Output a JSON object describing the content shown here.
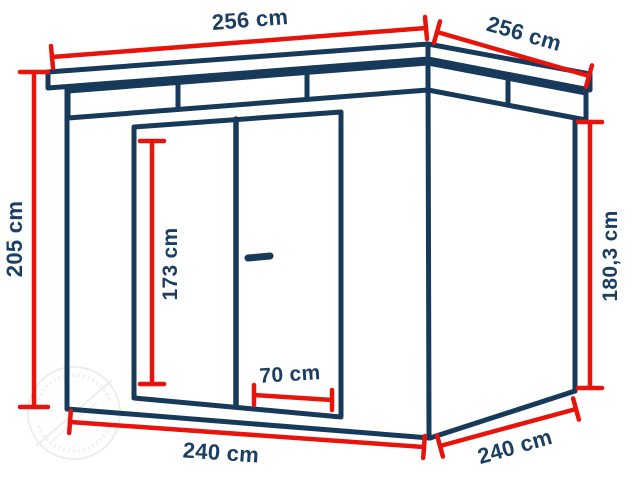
{
  "diagram": {
    "kind": "shed-dimension-drawing",
    "colors": {
      "outline_navy": "#17395a",
      "dimension_red": "#e8140c",
      "label_navy": "#1b3f63",
      "background": "#ffffff",
      "watermark_gray": "#d9d3cd"
    },
    "dimensions": {
      "roof_front_width": "256 cm",
      "roof_side_depth": "256 cm",
      "total_height_left": "205 cm",
      "door_height": "173 cm",
      "door_leaf_width": "70 cm",
      "wall_height_right": "180,3 cm",
      "base_front_width": "240 cm",
      "base_side_depth": "240 cm"
    },
    "watermark": {
      "note": "faint circular logo watermark, text illegible"
    }
  }
}
